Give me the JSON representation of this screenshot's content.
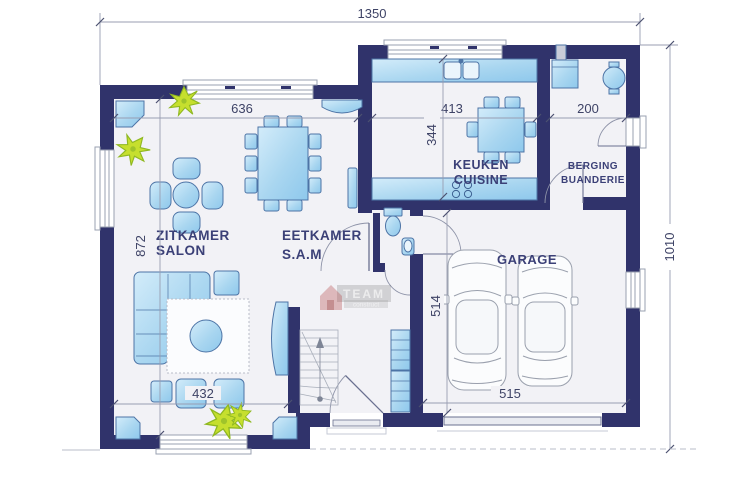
{
  "plan": {
    "rooms": {
      "living": {
        "line1": "ZITKAMER",
        "line2": "SALON"
      },
      "dining": {
        "line1": "EETKAMER",
        "line2": "S.A.M"
      },
      "kitchen": {
        "line1": "KEUKEN",
        "line2": "CUISINE"
      },
      "storage": {
        "line1": "BERGING",
        "line2": "BUANDERIE"
      },
      "garage": {
        "line1": "GARAGE"
      }
    },
    "dimensions": {
      "total_width": "1350",
      "total_height": "1010",
      "living_top_width": "636",
      "living_height": "872",
      "living_bottom_width": "432",
      "kitchen_width": "413",
      "kitchen_depth": "344",
      "storage_width": "200",
      "garage_depth": "514",
      "garage_width": "515"
    },
    "watermark": {
      "brand": "TEAM",
      "sub": "construct"
    },
    "colors": {
      "wall": "#30336b",
      "furniture_blue": "#a9d6f0",
      "plant_green": "#c6df2e",
      "floor": "#f2f2f6",
      "dimension_text": "#3e4366"
    }
  }
}
